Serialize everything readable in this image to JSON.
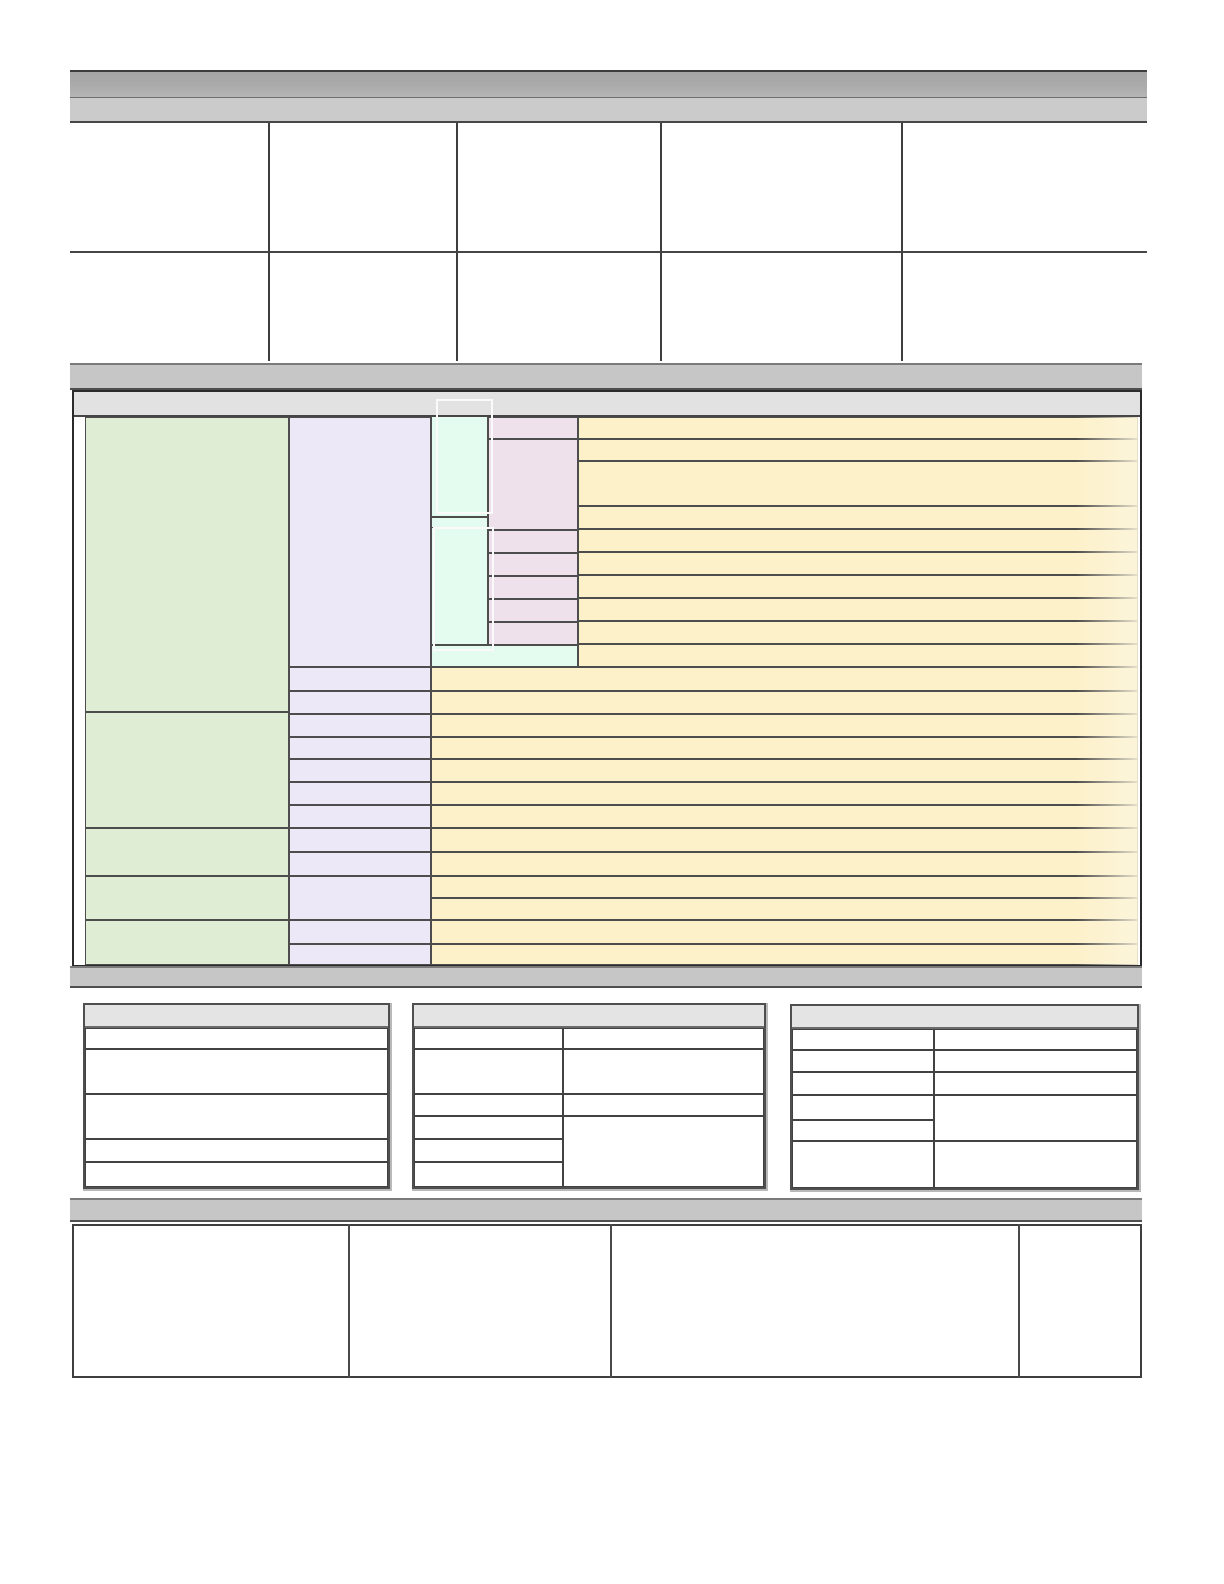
{
  "document": {
    "kind": "blank-form-template",
    "visible_text": "",
    "notes": "Template contains no rendered text; all cells are empty fill-in fields."
  },
  "colors": {
    "page-bg": "#ffffff",
    "bar-dark": "#ababab",
    "bar-light": "#cbcbcb",
    "bar-mid": "#c6c6c6",
    "band": "#e2e2e2",
    "table-header": "#e4e4e4",
    "green": "#e0edd5",
    "lavender": "#ece8f8",
    "mint": "#e4fcf0",
    "pink": "#eee1eb",
    "yellow": "#fdf1ca",
    "border-dark": "#4a4a4a",
    "box-outline": "#fafafa"
  },
  "structure": {
    "top_info_table": {
      "columns": 5,
      "rows": 2
    },
    "main_grid": {
      "green_blocks": 5,
      "lavender_cells": 13,
      "mint_cells": 3,
      "pink_cells": 7,
      "yellow_rows_upper": 10,
      "yellow_rows_lower": 13,
      "highlight_boxes": 2
    },
    "summary_tables": 3,
    "footer_table_columns": 4
  }
}
